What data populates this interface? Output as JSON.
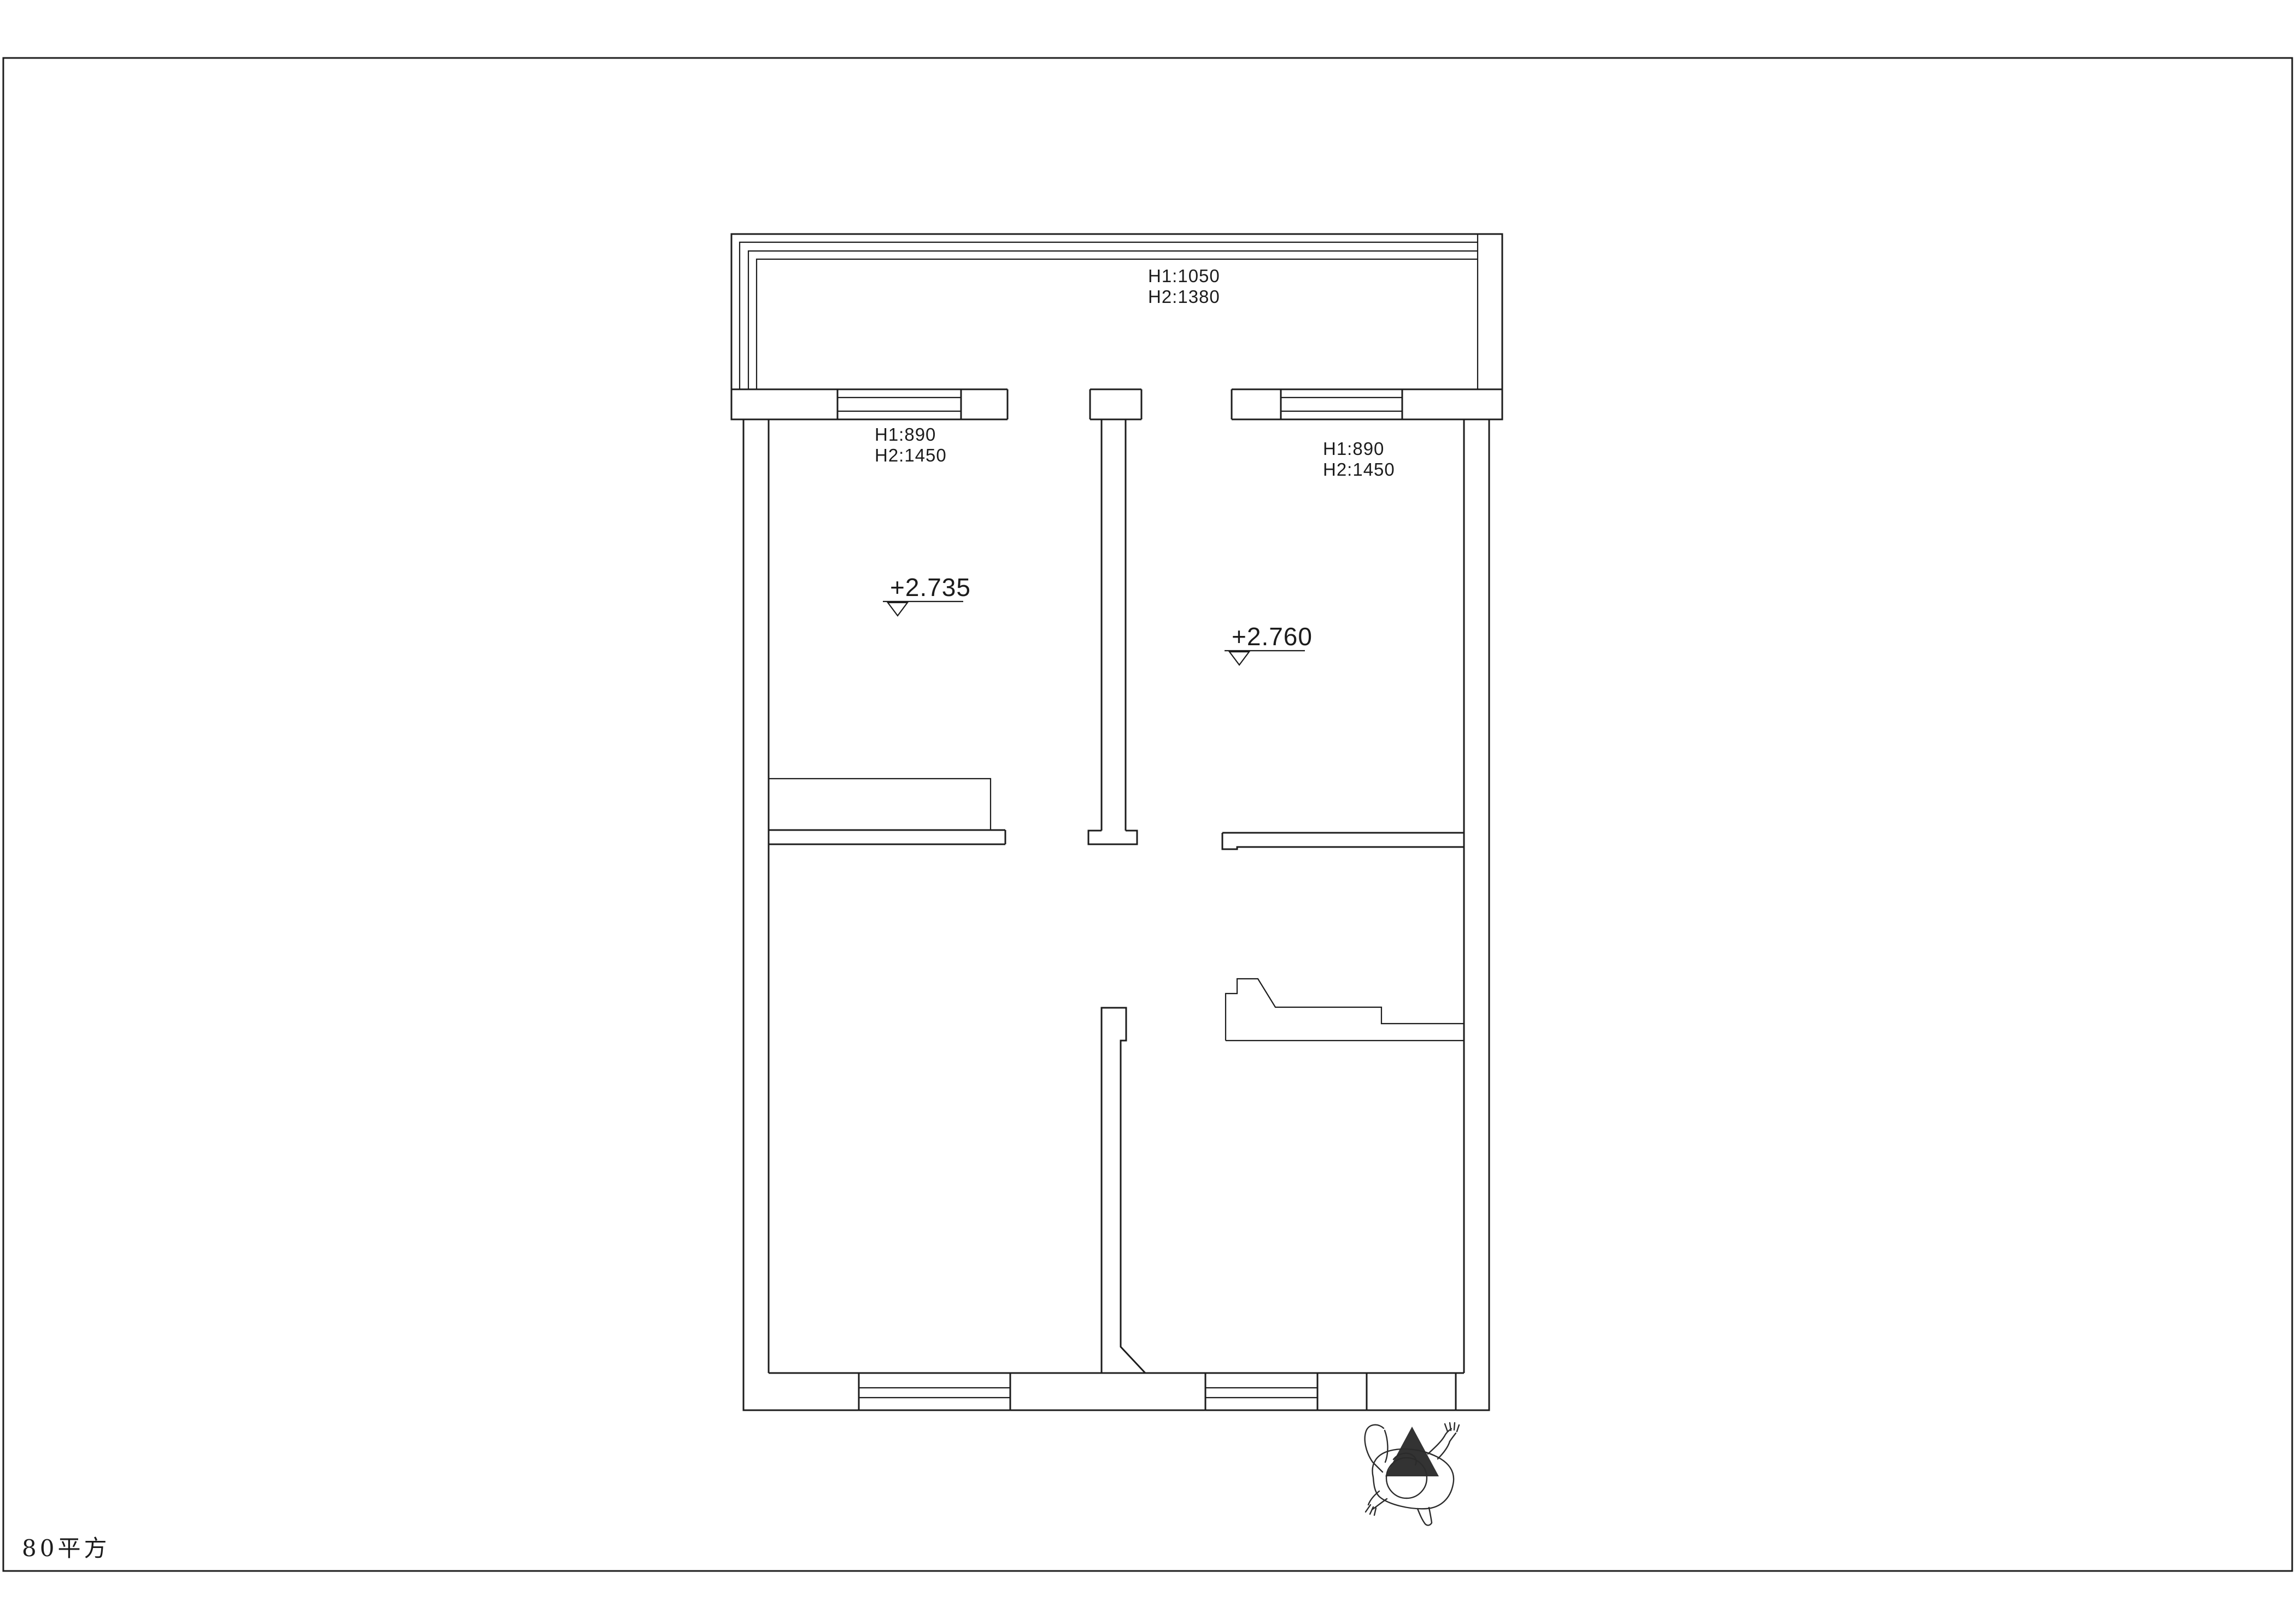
{
  "title_block": {
    "area_label": "80平方"
  },
  "colors": {
    "line": "#1c1c1c",
    "entrance_arrow": "#333333",
    "background": "#ffffff"
  },
  "annotations": {
    "balcony_window": {
      "line1": "H1:1050",
      "line2": "H2:1380"
    },
    "left_window": {
      "line1": "H1:890",
      "line2": "H2:1450"
    },
    "right_window": {
      "line1": "H1:890",
      "line2": "H2:1450"
    },
    "left_room_level": "+2.735",
    "right_room_level": "+2.760"
  }
}
